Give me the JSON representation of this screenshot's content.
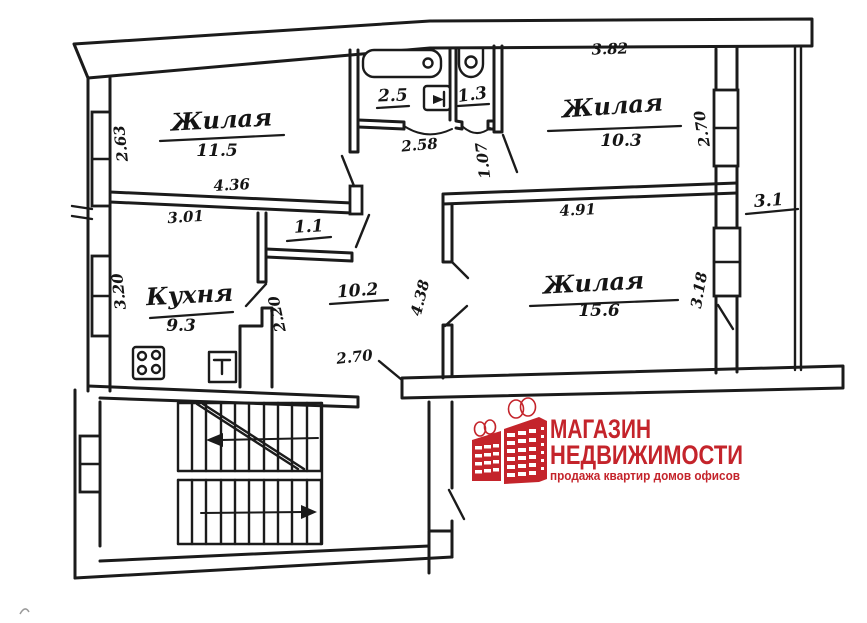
{
  "rooms": {
    "living1": {
      "label": "Жилая",
      "area": "11.5"
    },
    "living2": {
      "label": "Жилая",
      "area": "10.3"
    },
    "living3": {
      "label": "Жилая",
      "area": "15.6"
    },
    "kitchen": {
      "label": "Кухня",
      "area": "9.3"
    },
    "hallway": {
      "area": "10.2"
    },
    "closet": {
      "area": "1.1"
    },
    "bath": {
      "area": "2.5"
    },
    "wc": {
      "area": "1.3"
    },
    "balcony": {
      "area": "3.1"
    }
  },
  "dimensions": {
    "room11_width": "4.36",
    "room11_depth": "2.63",
    "kitchen_top": "3.01",
    "kitchen_left": "3.20",
    "kitchen_right": "2.20",
    "bath_width": "2.58",
    "wc_width": "1.07",
    "room10_width": "3.82",
    "room10_depth": "2.70",
    "room15_width": "4.91",
    "room15_depth": "3.18",
    "hall_depth": "4.38",
    "hall_width": "2.70"
  },
  "logo": {
    "line1": "МАГАЗИН",
    "line2": "НЕДВИЖИМОСТИ",
    "tagline": "продажа  квартир  домов  офисов",
    "brand_color": "#c4242b"
  }
}
